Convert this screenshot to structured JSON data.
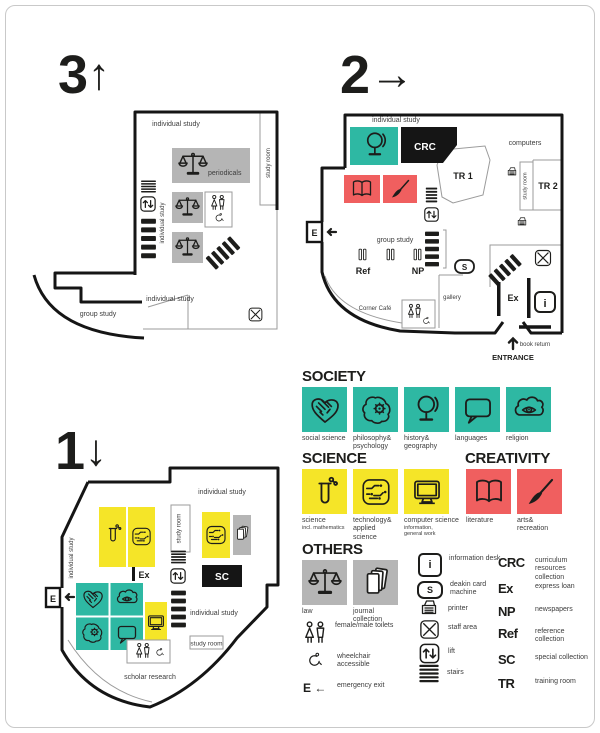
{
  "colors": {
    "teal": "#2eb8a3",
    "yellow": "#f5e528",
    "red": "#f05f5f",
    "gray": "#b5b5b5",
    "ink": "#1d1d1b"
  },
  "floor3": {
    "number": "3",
    "arrow": "↑",
    "labels": {
      "individual_study_top": "individual study",
      "study_room": "study room",
      "periodicals": "periodicals",
      "individual_study_left": "individual study",
      "individual_study_bottom": "individual study",
      "group_study": "group study"
    }
  },
  "floor2": {
    "number": "2",
    "arrow": "→",
    "labels": {
      "individual_study": "individual study",
      "crc": "CRC",
      "computers": "computers",
      "tr1": "TR 1",
      "tr2": "TR 2",
      "study_room": "study room",
      "group_study": "group study",
      "ref": "Ref",
      "np": "NP",
      "s": "S",
      "gallery": "gallery",
      "corner_cafe": "Corner Café",
      "ex": "Ex",
      "info": "i",
      "emergency": "E",
      "entrance": "ENTRANCE",
      "book_return": "book return"
    }
  },
  "floor1": {
    "number": "1",
    "arrow": "↓",
    "labels": {
      "individual_study_top": "individual study",
      "study_room_top": "study room",
      "study_room_bottom": "study room",
      "sc": "SC",
      "ex": "Ex",
      "emergency": "E",
      "individual_study_left": "individual study",
      "individual_study_right": "individual study",
      "scholar_research": "scholar research"
    }
  },
  "legend": {
    "society": {
      "title": "SOCIETY",
      "items": [
        {
          "label": "social science"
        },
        {
          "label": "philosophy& psychology"
        },
        {
          "label": "history& geography"
        },
        {
          "label": "languages"
        },
        {
          "label": "religion"
        }
      ]
    },
    "science": {
      "title": "SCIENCE",
      "items": [
        {
          "label": "science",
          "sublabel": "incl. mathematics"
        },
        {
          "label": "technology& applied science",
          "sublabel": ""
        },
        {
          "label": "computer science",
          "sublabel": "information, general work"
        }
      ]
    },
    "creativity": {
      "title": "CREATIVITY",
      "items": [
        {
          "label": "literature"
        },
        {
          "label": "arts& recreation"
        }
      ]
    },
    "others": {
      "title": "OTHERS",
      "law": "law",
      "journal": "journal collection",
      "toilets": "female/male toilets",
      "wheelchair": "wheelchair accessible",
      "emergency_glyph": "E ←",
      "emergency": "emergency exit",
      "info_glyph": "i",
      "info": "information desk",
      "card_glyph": "S",
      "card": "deakin card machine",
      "printer": "printer",
      "staff": "staff area",
      "lift": "lift",
      "stairs": "stairs",
      "abbrevs": [
        {
          "code": "CRC",
          "label": "curriculum resources collection"
        },
        {
          "code": "Ex",
          "label": "express loan"
        },
        {
          "code": "NP",
          "label": "newspapers"
        },
        {
          "code": "Ref",
          "label": "reference collection"
        },
        {
          "code": "SC",
          "label": "special collection"
        },
        {
          "code": "TR",
          "label": "training room"
        }
      ]
    }
  }
}
